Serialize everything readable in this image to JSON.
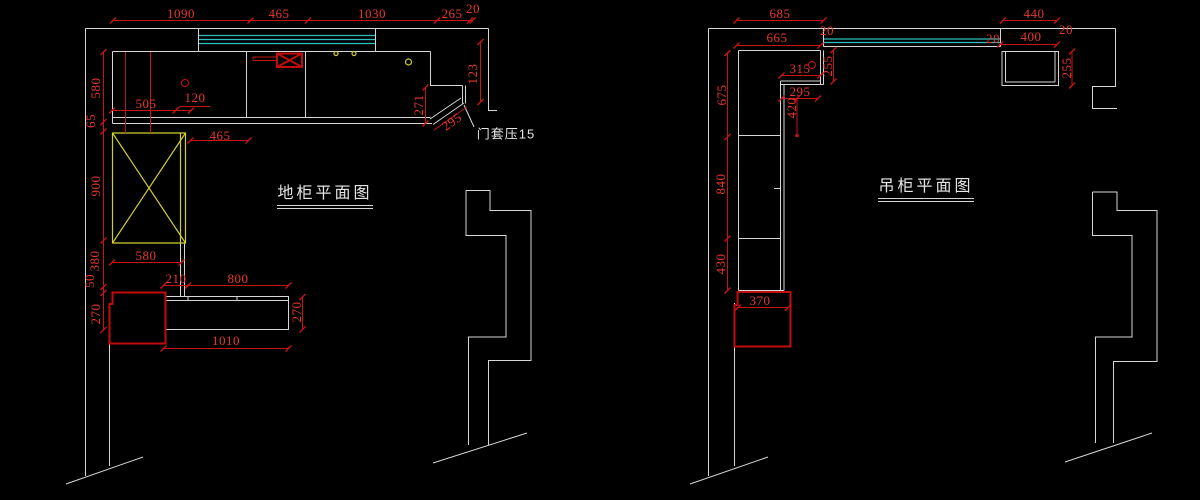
{
  "drawing": {
    "background": "#000000",
    "colors": {
      "wall_line": "#d6d6d6",
      "dimension_line": "#c41414",
      "dimension_text": "#e8382a",
      "window_band": "#2fbdbd",
      "highlight_box": "#cfcf33",
      "appliance_box": "#bf0d0d",
      "title_text": "#e6e6e6"
    }
  },
  "plans": [
    {
      "id": "base-cabinet",
      "title": "地柜平面图"
    },
    {
      "id": "wall-cabinet",
      "title": "吊柜平面图"
    }
  ],
  "annotations": {
    "door_casing": "门套压15"
  },
  "dim_labels": [
    {
      "text": "1090",
      "x": 181,
      "y": 14
    },
    {
      "text": "465",
      "x": 279,
      "y": 14
    },
    {
      "text": "1030",
      "x": 372,
      "y": 14
    },
    {
      "text": "265",
      "x": 452,
      "y": 14
    },
    {
      "text": "20",
      "x": 473,
      "y": 9
    },
    {
      "text": "580",
      "x": 96,
      "y": 88,
      "rot": -90
    },
    {
      "text": "65",
      "x": 91,
      "y": 121,
      "rot": -90
    },
    {
      "text": "900",
      "x": 96,
      "y": 186,
      "rot": -90
    },
    {
      "text": "380",
      "x": 95,
      "y": 261,
      "rot": -90
    },
    {
      "text": "50",
      "x": 90,
      "y": 281,
      "rot": -90
    },
    {
      "text": "270",
      "x": 96,
      "y": 314,
      "rot": -90
    },
    {
      "text": "505",
      "x": 146,
      "y": 104
    },
    {
      "text": "120",
      "x": 195,
      "y": 98
    },
    {
      "text": "465",
      "x": 220,
      "y": 136
    },
    {
      "text": "580",
      "x": 146,
      "y": 256
    },
    {
      "text": "210",
      "x": 176,
      "y": 279
    },
    {
      "text": "800",
      "x": 238,
      "y": 279
    },
    {
      "text": "270",
      "x": 297,
      "y": 312,
      "rot": -90
    },
    {
      "text": "1010",
      "x": 226,
      "y": 341
    },
    {
      "text": "271",
      "x": 419,
      "y": 105,
      "rot": -90
    },
    {
      "text": "123",
      "x": 473,
      "y": 74,
      "rot": -90
    },
    {
      "text": "295",
      "x": 452,
      "y": 122,
      "rot": -35
    },
    {
      "text": "门套压15",
      "x": 506,
      "y": 133,
      "cls": "note"
    },
    {
      "text": "685",
      "x": 780,
      "y": 14
    },
    {
      "text": "440",
      "x": 1034,
      "y": 14
    },
    {
      "text": "665",
      "x": 777,
      "y": 38
    },
    {
      "text": "20",
      "x": 827,
      "y": 31
    },
    {
      "text": "20",
      "x": 993,
      "y": 39
    },
    {
      "text": "400",
      "x": 1031,
      "y": 37
    },
    {
      "text": "20",
      "x": 1066,
      "y": 30
    },
    {
      "text": "675",
      "x": 722,
      "y": 95,
      "rot": -90
    },
    {
      "text": "840",
      "x": 721,
      "y": 184,
      "rot": -90
    },
    {
      "text": "430",
      "x": 721,
      "y": 264,
      "rot": -90
    },
    {
      "text": "315",
      "x": 800,
      "y": 69
    },
    {
      "text": "255",
      "x": 828,
      "y": 66,
      "rot": -90
    },
    {
      "text": "295",
      "x": 800,
      "y": 92
    },
    {
      "text": "420",
      "x": 792,
      "y": 108,
      "rot": -90
    },
    {
      "text": "255",
      "x": 1067,
      "y": 68,
      "rot": -90
    },
    {
      "text": "370",
      "x": 760,
      "y": 301
    }
  ]
}
